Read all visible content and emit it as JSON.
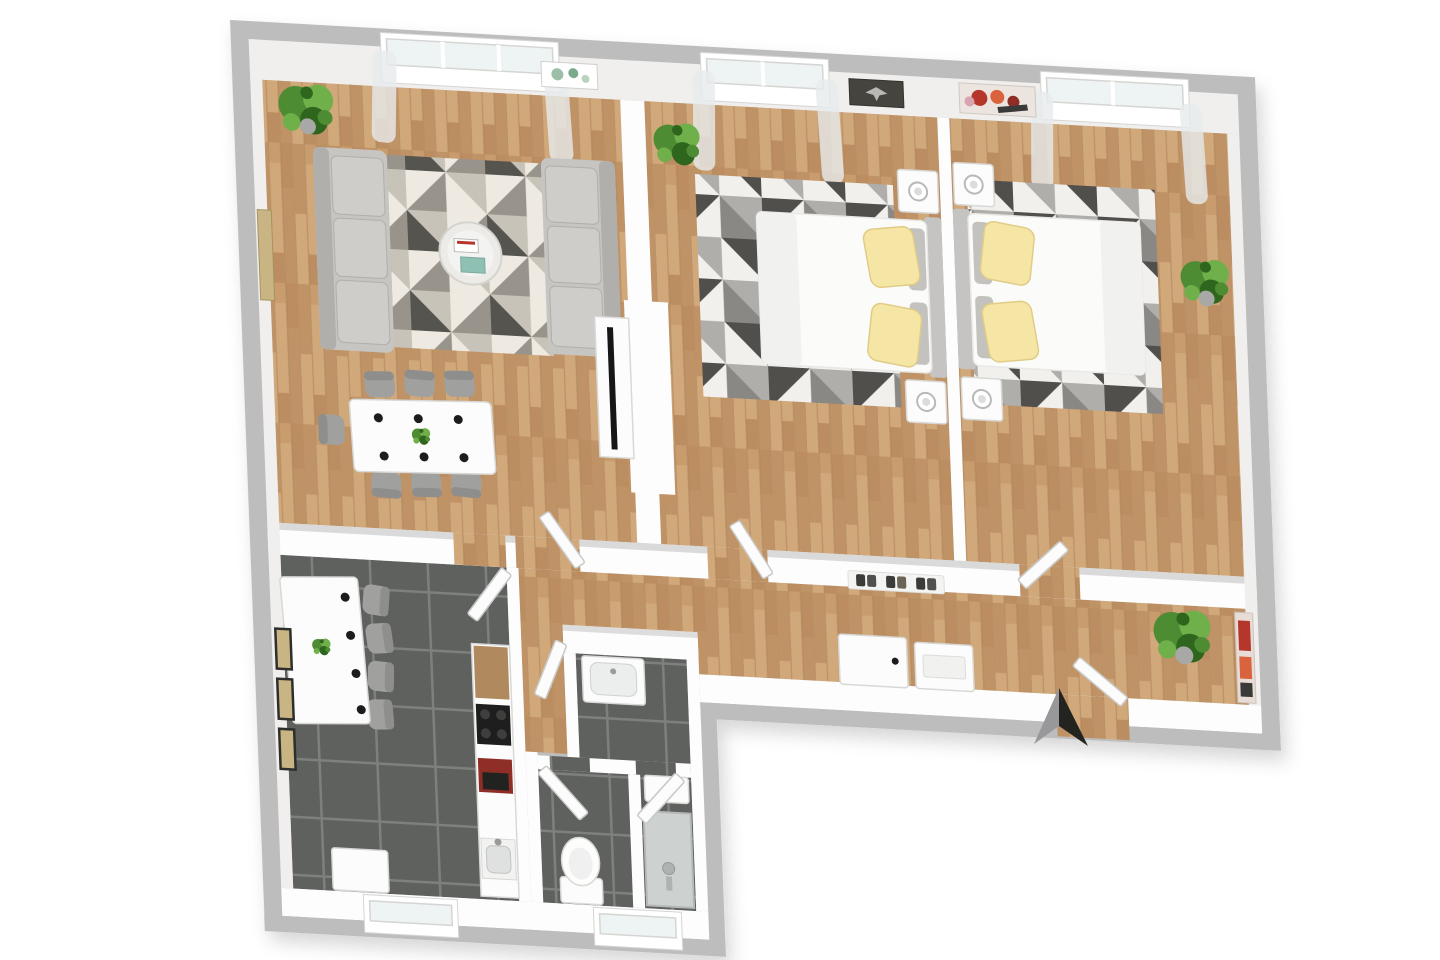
{
  "scene": {
    "kind": "3d-floorplan-render",
    "view": "top-down dollhouse view, slightly tilted",
    "apartment": "2-bedroom apartment with living room, kitchen, bathroom, WC and hallway"
  },
  "colors": {
    "wallGray": "#bdbdbd",
    "wallWhite": "#fdfdfd",
    "wallFace": "#f0efee",
    "furnWhite": "#fcfcfc",
    "furnStroke": "#d8d8d6",
    "doorEdge": "#c9c9c7",
    "wood": "#c89c6d",
    "wood2": "#c09367",
    "wood3": "#d1a87a",
    "wood4": "#bb8d60",
    "tile": "#5f615f",
    "grout": "#7d807d",
    "rugBase": "#ded9cf",
    "rugA": "#eeeae2",
    "rugB": "#c7c3b9",
    "rugC": "#98948c",
    "rugD": "#56544e",
    "bedRugA": "#f1f0ed",
    "bedRugB": "#b0aeaa",
    "bedRugC": "#504f4b",
    "bedRugD": "#8a8884",
    "sofa": "#c7c5c1",
    "sofaDark": "#b1afab",
    "cushion": "#cfcdc9",
    "chairGray": "#a0a09e",
    "chairDark": "#8e8e8c",
    "pillowY": "#f5e6a6",
    "pillowEdge": "#e0cc86",
    "cushGray": "#c4c2be",
    "mattress": "#fbfbfa",
    "headboard": "#c6c4c2",
    "plantG": "#4e8c33",
    "plantD": "#2f661e",
    "plantL": "#6fb04a",
    "pot": "#a8a8a6",
    "dot": "#1c1c1c",
    "tvBlack": "#161616",
    "orange": "#d97a2e",
    "artTan": "#c9b583",
    "artRed": "#b5362a",
    "artDark": "#45443f",
    "counterWood": "#b08a5e",
    "cooktop": "#1e1e1e",
    "appliRed": "#8e2e26",
    "shower": "#cdd1cf",
    "showerRim": "#b4b8b6",
    "curtain": "#e7ebec",
    "glass": "#eef3f4",
    "winFrame": "#d5d5d3",
    "northD": "#23231f",
    "northL": "#98989a"
  },
  "rooms": [
    {
      "id": "living-room",
      "label": "Living / dining room",
      "floor": "light oak parquet",
      "furniture": [
        "3-seater sofa (left)",
        "3-seater sofa (right)",
        "geometric triangle rug",
        "round glass coffee table with books and teal tray",
        "TV sideboard with flat TV",
        "dining table with 6 place dots and small plant",
        "7 gray chairs",
        "potted plant (top-left corner)",
        "green botanical wall art",
        "tan wall art (left wall)",
        "window with sheer curtains"
      ]
    },
    {
      "id": "bedroom-1",
      "label": "Bedroom 1 (center)",
      "floor": "light oak parquet",
      "furniture": [
        "double bed, head at right wall, white duvet",
        "2 yellow pillows",
        "2 gray back cushions",
        "2 white nightstands with round lamps",
        "dark triangle-pattern rug",
        "dark wall art with eagle motif",
        "potted plant",
        "window with sheer curtains",
        "white interior door (open)"
      ]
    },
    {
      "id": "bedroom-2",
      "label": "Bedroom 2 (right)",
      "floor": "light oak parquet",
      "furniture": [
        "double bed, head at left wall, white duvet",
        "2 yellow pillows",
        "2 gray back cushions",
        "2 white nightstands with round lamps",
        "dark triangle-pattern rug",
        "red abstract wall art",
        "potted plant",
        "window with sheer curtains",
        "white interior door (open)"
      ]
    },
    {
      "id": "hallway",
      "label": "Hallway",
      "floor": "light oak parquet",
      "furniture": [
        "wall shelf with 3 pairs of dark shoes",
        "small white desk with orange stool",
        "white shoe cabinet",
        "potted plant",
        "red painting on right wall",
        "entrance door (open)"
      ]
    },
    {
      "id": "kitchen",
      "label": "Kitchen",
      "floor": "dark gray tiles",
      "furniture": [
        "white breakfast table with 4 place dots and small plant",
        "4 gray chairs",
        "3 framed pictures on left wall",
        "kitchen counter with wood worktop, black cooktop, red coffee machine and sink",
        "white cabinet / fridge at bottom wall",
        "window in bottom wall",
        "white interior door (open)"
      ]
    },
    {
      "id": "bathroom",
      "label": "Bathroom, WC and shower room",
      "floor": "dark gray tiles",
      "furniture": [
        "white washbasin unit",
        "toilet",
        "shower with gray tray and hand shower",
        "white shelf in shower room",
        "window in bottom wall",
        "3 white interior doors (open)"
      ]
    }
  ],
  "compass": {
    "type": "north-arrow",
    "position": "outside entrance, bottom right"
  }
}
